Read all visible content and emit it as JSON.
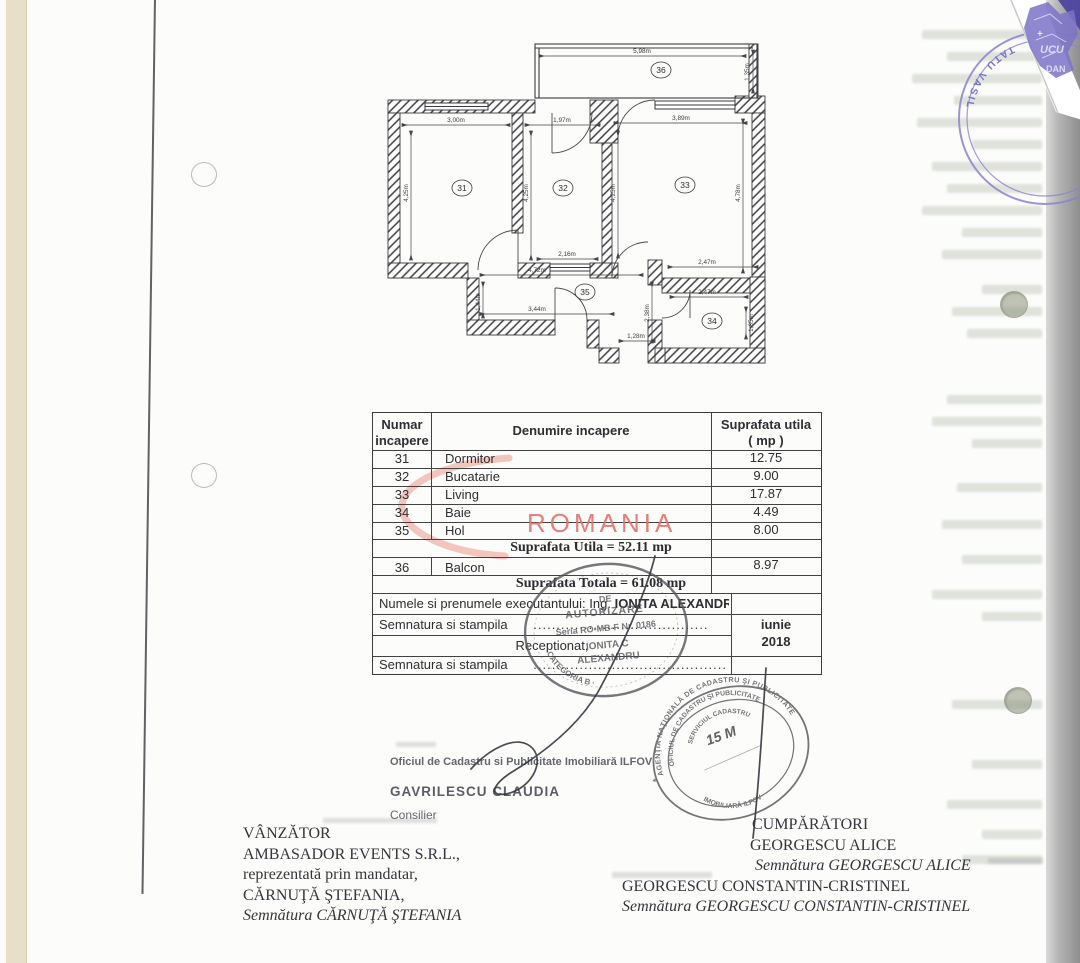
{
  "page": {
    "watermark": "ROMANIA"
  },
  "plan": {
    "rooms": [
      "31",
      "32",
      "33",
      "34",
      "35",
      "36"
    ],
    "dims": [
      "5,98m",
      "1,35m",
      "3,00m",
      "1,97m",
      "3,89m",
      "4,25m",
      "4,25m",
      "4,25m",
      "4,78m",
      "2,16m",
      "4,72m",
      "1,44m",
      "3,44m",
      "1,28m",
      "2,47m",
      "2,47m",
      "1,85m",
      "2,38m"
    ]
  },
  "table": {
    "headers": {
      "col1a": "Numar",
      "col1b": "incapere",
      "col2": "Denumire incapere",
      "col3a": "Suprafata utila",
      "col3b": "( mp )"
    },
    "rows": [
      {
        "num": "31",
        "name": "Dormitor",
        "area": "12.75"
      },
      {
        "num": "32",
        "name": "Bucatarie",
        "area": "9.00"
      },
      {
        "num": "33",
        "name": "Living",
        "area": "17.87"
      },
      {
        "num": "34",
        "name": "Baie",
        "area": "4.49"
      },
      {
        "num": "35",
        "name": "Hol",
        "area": "8.00"
      }
    ],
    "util_total": "Suprafata Utila = 52.11 mp",
    "balcon_row": {
      "num": "36",
      "name": "Balcon",
      "area": "8.97"
    },
    "grand_total": "Suprafata Totala = 61.08 mp",
    "exec_label": "Numele si prenumele executantului: Ing.",
    "exec_name": "IONITA ALEXANDRU",
    "sig_label1": "Semnatura si stampila",
    "sig_dots1": "......................................",
    "received_label": "Receptionat,",
    "sig_label2": "Semnatura si stampila",
    "sig_dots2": "..........................................",
    "date_month": "iunie",
    "date_year": "2018"
  },
  "stamps": {
    "authorization": {
      "line1": "DE",
      "line2": "AUTORIZARE",
      "line3": "Seria RO-MB-F Nr. 0186",
      "line4": "IONITA C",
      "line5": "ALEXANDRU",
      "arc_bottom": "· CATEGORIA B ·"
    },
    "ancpi": {
      "arc_top": "AGENŢIA NAŢIONALĂ DE CADASTRU ŞI PUBLICITATE",
      "arc_mid": "OFICIUL DE CADASTRU ŞI PUBLICITATE",
      "arc_bottom": "IMOBILIARĂ ILFOV",
      "arc_inner": "SERVICIUL CADASTRU",
      "date": "15 M"
    },
    "notary": {
      "arc": "TATU VASIL",
      "frag1": "UCU",
      "frag2": "DAN",
      "frag3": "+"
    }
  },
  "officials": {
    "office_line": "Oficiul de Cadastru si Publicitate Imobiliară ILFOV",
    "name": "GAVRILESCU CLAUDIA",
    "role": "Consilier"
  },
  "seller": {
    "heading": "VÂNZĂTOR",
    "company": "AMBASADOR EVENTS S.R.L.,",
    "rep": "reprezentată prin mandatar,",
    "name": "CĂRNUŢĂ ŞTEFANIA,",
    "signature": "Semnătura CĂRNUŢĂ ŞTEFANIA"
  },
  "buyers": {
    "heading": "CUMPĂRĂTORI",
    "buyer1": "GEORGESCU ALICE",
    "sig1": "Semnătura GEORGESCU ALICE",
    "buyer2": "GEORGESCU CONSTANTIN-CRISTINEL",
    "sig2": "Semnătura  GEORGESCU  CONSTANTIN-CRISTINEL"
  },
  "colors": {
    "watermark": "#e0746c",
    "notary_purple": "#7b73c9",
    "stamp_gray": "#55555c",
    "ink": "#33383f"
  }
}
